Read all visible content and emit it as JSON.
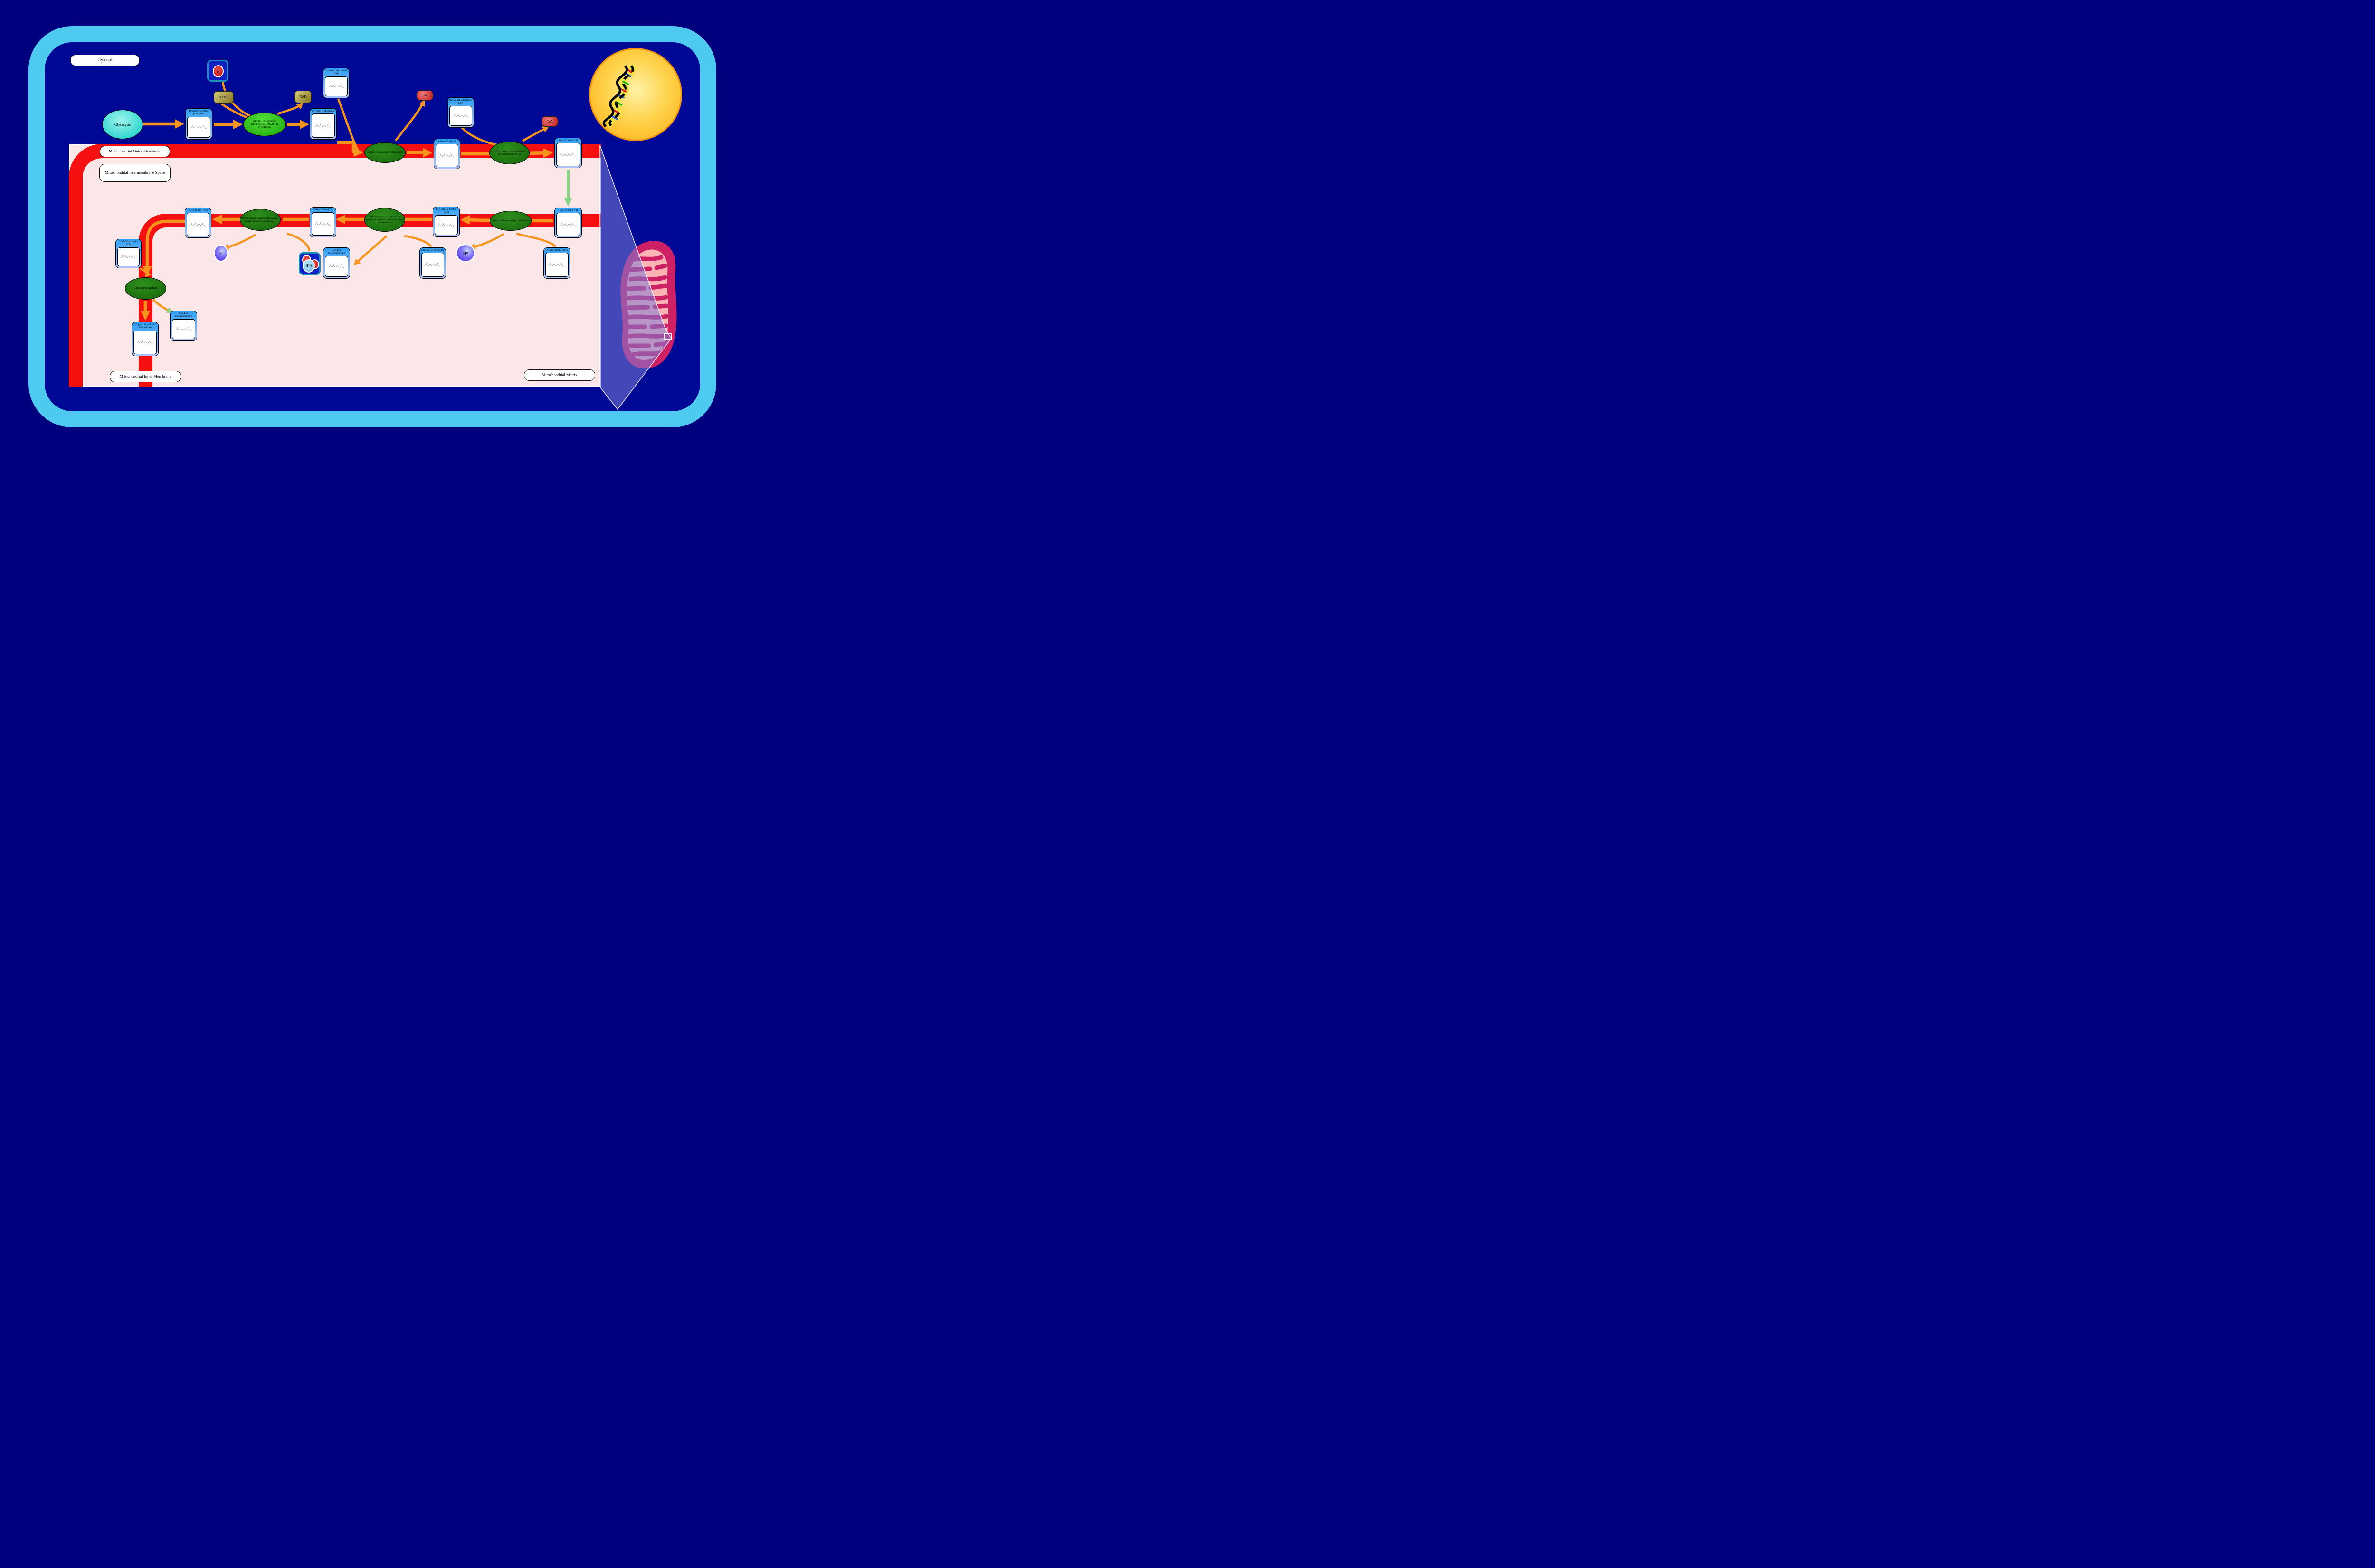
{
  "compartments": {
    "cytosol": "Cytosol",
    "outer_membrane": "Mitochondrial Outer Membrane",
    "intermembrane_space": "Mitochondrial Intermembrane Space",
    "inner_membrane": "Mitochondrial Inner Membrane",
    "matrix": "Mitochondrial Matrix"
  },
  "process": {
    "glycolysis": "Glycolysis"
  },
  "enzymes": {
    "gpd1": "Glycerol-3-phosphate dehydrogenase [NAD(+)], cytoplasmic",
    "gpat": "Glycerol-3-phosphate acyltransferase",
    "agpat_epsilon": "1-Acyl-sn-glycerol-3-phosphate acyltransferase epsilon",
    "pcyt2": "Phosphatidate cytidylyltransferase 2",
    "pgs1": "CDP-diacylglycerol--glycerol-3-phosphate 3-phosphatidyltransferase, mitochondrial",
    "ptpmt1": "Phosphatidylglycerophosphatase and protein-tyrosine phosphatase 1",
    "crls": "Cardiolipin synthase"
  },
  "metabolites": {
    "dhap": "Dihydroxyacetone phosphate",
    "g3p_cytosolic": "Glycerol 3-phosphate",
    "anteisotridecanoyl_coa": "Anteisotridecanoyl-CoA",
    "anteisoheptadecanoyl_coa": "Anteisoheptadecanoyl-CoA",
    "lpa": "LPA(a-13:0/0:0)",
    "pa_upper": "PA(a-13:0/a-17:0)",
    "pa_lower": "PA(a-13:0/a-17:0)",
    "cdp_dg": "CDP-DG(a-13:0/a-17:0)",
    "pgp": "PGP(a-13:0/a-17:0)",
    "pg": "PG(a-13:0/a-17:0)",
    "cdp_dg_2": "CDP-DG(i-19:0/i-12:0)",
    "cl": "CL(a-13:0/a-17:0/i-19:0/i-12:0)",
    "cmp_inner": "Cytidine monophosphate",
    "cmp_matrix": "Cytidine monophosphate",
    "g3p_matrix": "Glycerol 3-phosphate",
    "ctp": "Cytidine triphosphate"
  },
  "cofactors": {
    "nadh": "NADH",
    "nad": "NAD",
    "h_plus": {
      "symbol": "H",
      "charge": "+"
    },
    "coa_1": "CoA",
    "coa_2": "CoA",
    "pi": {
      "symbol": "P",
      "sub": "i"
    },
    "ppi": {
      "symbol": "PP",
      "sub": "i"
    },
    "h2o": {
      "h": "H",
      "sub": "2",
      "o": "O"
    }
  },
  "colors": {
    "background_navy": "#00007E",
    "cell_border_blue": "#4EC9F0",
    "cell_fill": "#000896",
    "membrane_red": "#F61010",
    "panel_pink": "#FBE7E7",
    "node_blue": "#2E9FF5",
    "enzyme_green_dark": "#1B6E0E",
    "enzyme_green_bright": "#3ECF2C",
    "arrow_orange": "#F7941E",
    "transport_arrow_green": "#86D584",
    "glycolysis_cyan": "#25D3CE",
    "nucleus_yellow": "#FFC830",
    "mitochondrion_pink": "#CE2165",
    "zoom_beam_purple": "#7B7BD6"
  }
}
